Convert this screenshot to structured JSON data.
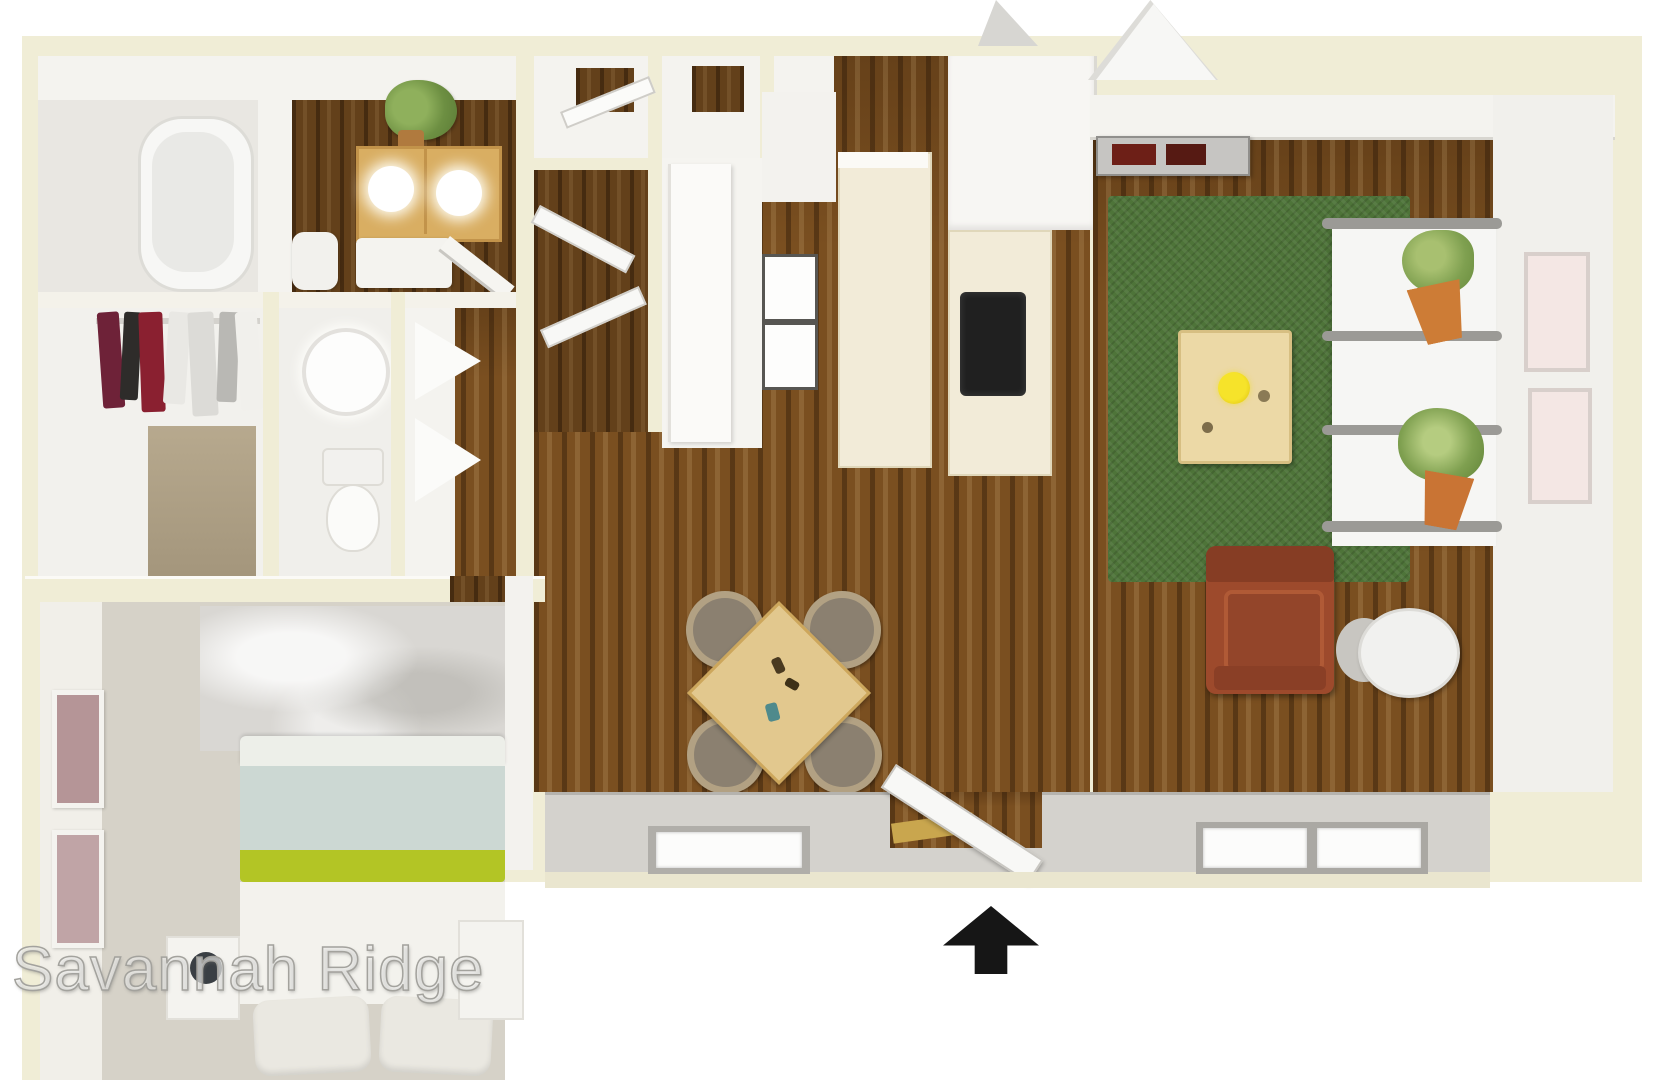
{
  "watermark": {
    "text": "Savannah Ridge"
  },
  "floor_plan": {
    "type": "3d-rendered-floor-plan",
    "entry_arrow_direction": "up",
    "rooms": [
      {
        "name": "bathroom",
        "furniture": [
          "bathtub"
        ]
      },
      {
        "name": "breakfast-nook",
        "furniture": [
          "table",
          "two-plates",
          "chair",
          "bench",
          "plant",
          "open-door"
        ]
      },
      {
        "name": "walk-in-closet",
        "furniture": [
          "clothes-rod",
          "hanging-clothes"
        ]
      },
      {
        "name": "hall-bathroom",
        "furniture": [
          "round-sink",
          "toilet"
        ]
      },
      {
        "name": "linen-closet",
        "furniture": [
          "shelves",
          "folded-towels"
        ]
      },
      {
        "name": "bedroom",
        "furniture": [
          "bed",
          "lime-stripe-blanket",
          "pillows",
          "nightstand-left",
          "lamp",
          "nightstand-right",
          "wall-art-frames",
          "area-rug"
        ]
      },
      {
        "name": "hallway",
        "furniture": [
          "closets",
          "tall-cabinet",
          "stacked-washer-dryer"
        ]
      },
      {
        "name": "kitchen",
        "furniture": [
          "island-counter",
          "counter",
          "cooktop",
          "refrigerator"
        ]
      },
      {
        "name": "dining-area",
        "furniture": [
          "square-table",
          "four-chairs",
          "window"
        ]
      },
      {
        "name": "living-room",
        "furniture": [
          "tv-console",
          "green-area-rug",
          "coffee-table",
          "flower-vase",
          "plant-rack",
          "two-potted-plants",
          "armchair",
          "side-table",
          "wall-art-frames",
          "double-window"
        ]
      }
    ]
  },
  "palette": {
    "bg": "#ffffff",
    "cream": "#f0edd6",
    "wall": "#f4f3ef",
    "wall-shadow": "#d8d6d0",
    "floor-light": "#e9e7e2",
    "carpet": "#d6d2c8",
    "wood-dark": "#63401a",
    "wood-mid": "#7a4f20",
    "rug-green": "#4e7439",
    "table-tan": "#d9ae62",
    "dining-wood": "#e2c88e",
    "coffee-wood": "#ecd9a6",
    "chair-gray": "#8b8070",
    "chair-ring": "#b2a183",
    "armchair-rust": "#9d4a2c",
    "pot-orange": "#cd7c36",
    "foliage": "#7fa050",
    "lime": "#b3c525",
    "bed-blue": "#ccd8d3",
    "art-pink": "#f4e7e4",
    "art-mauve": "#b59597",
    "cooktop": "#202020",
    "console-red": "#6d1f17",
    "walkway": "#d4d2cd",
    "arrow": "#161616"
  }
}
